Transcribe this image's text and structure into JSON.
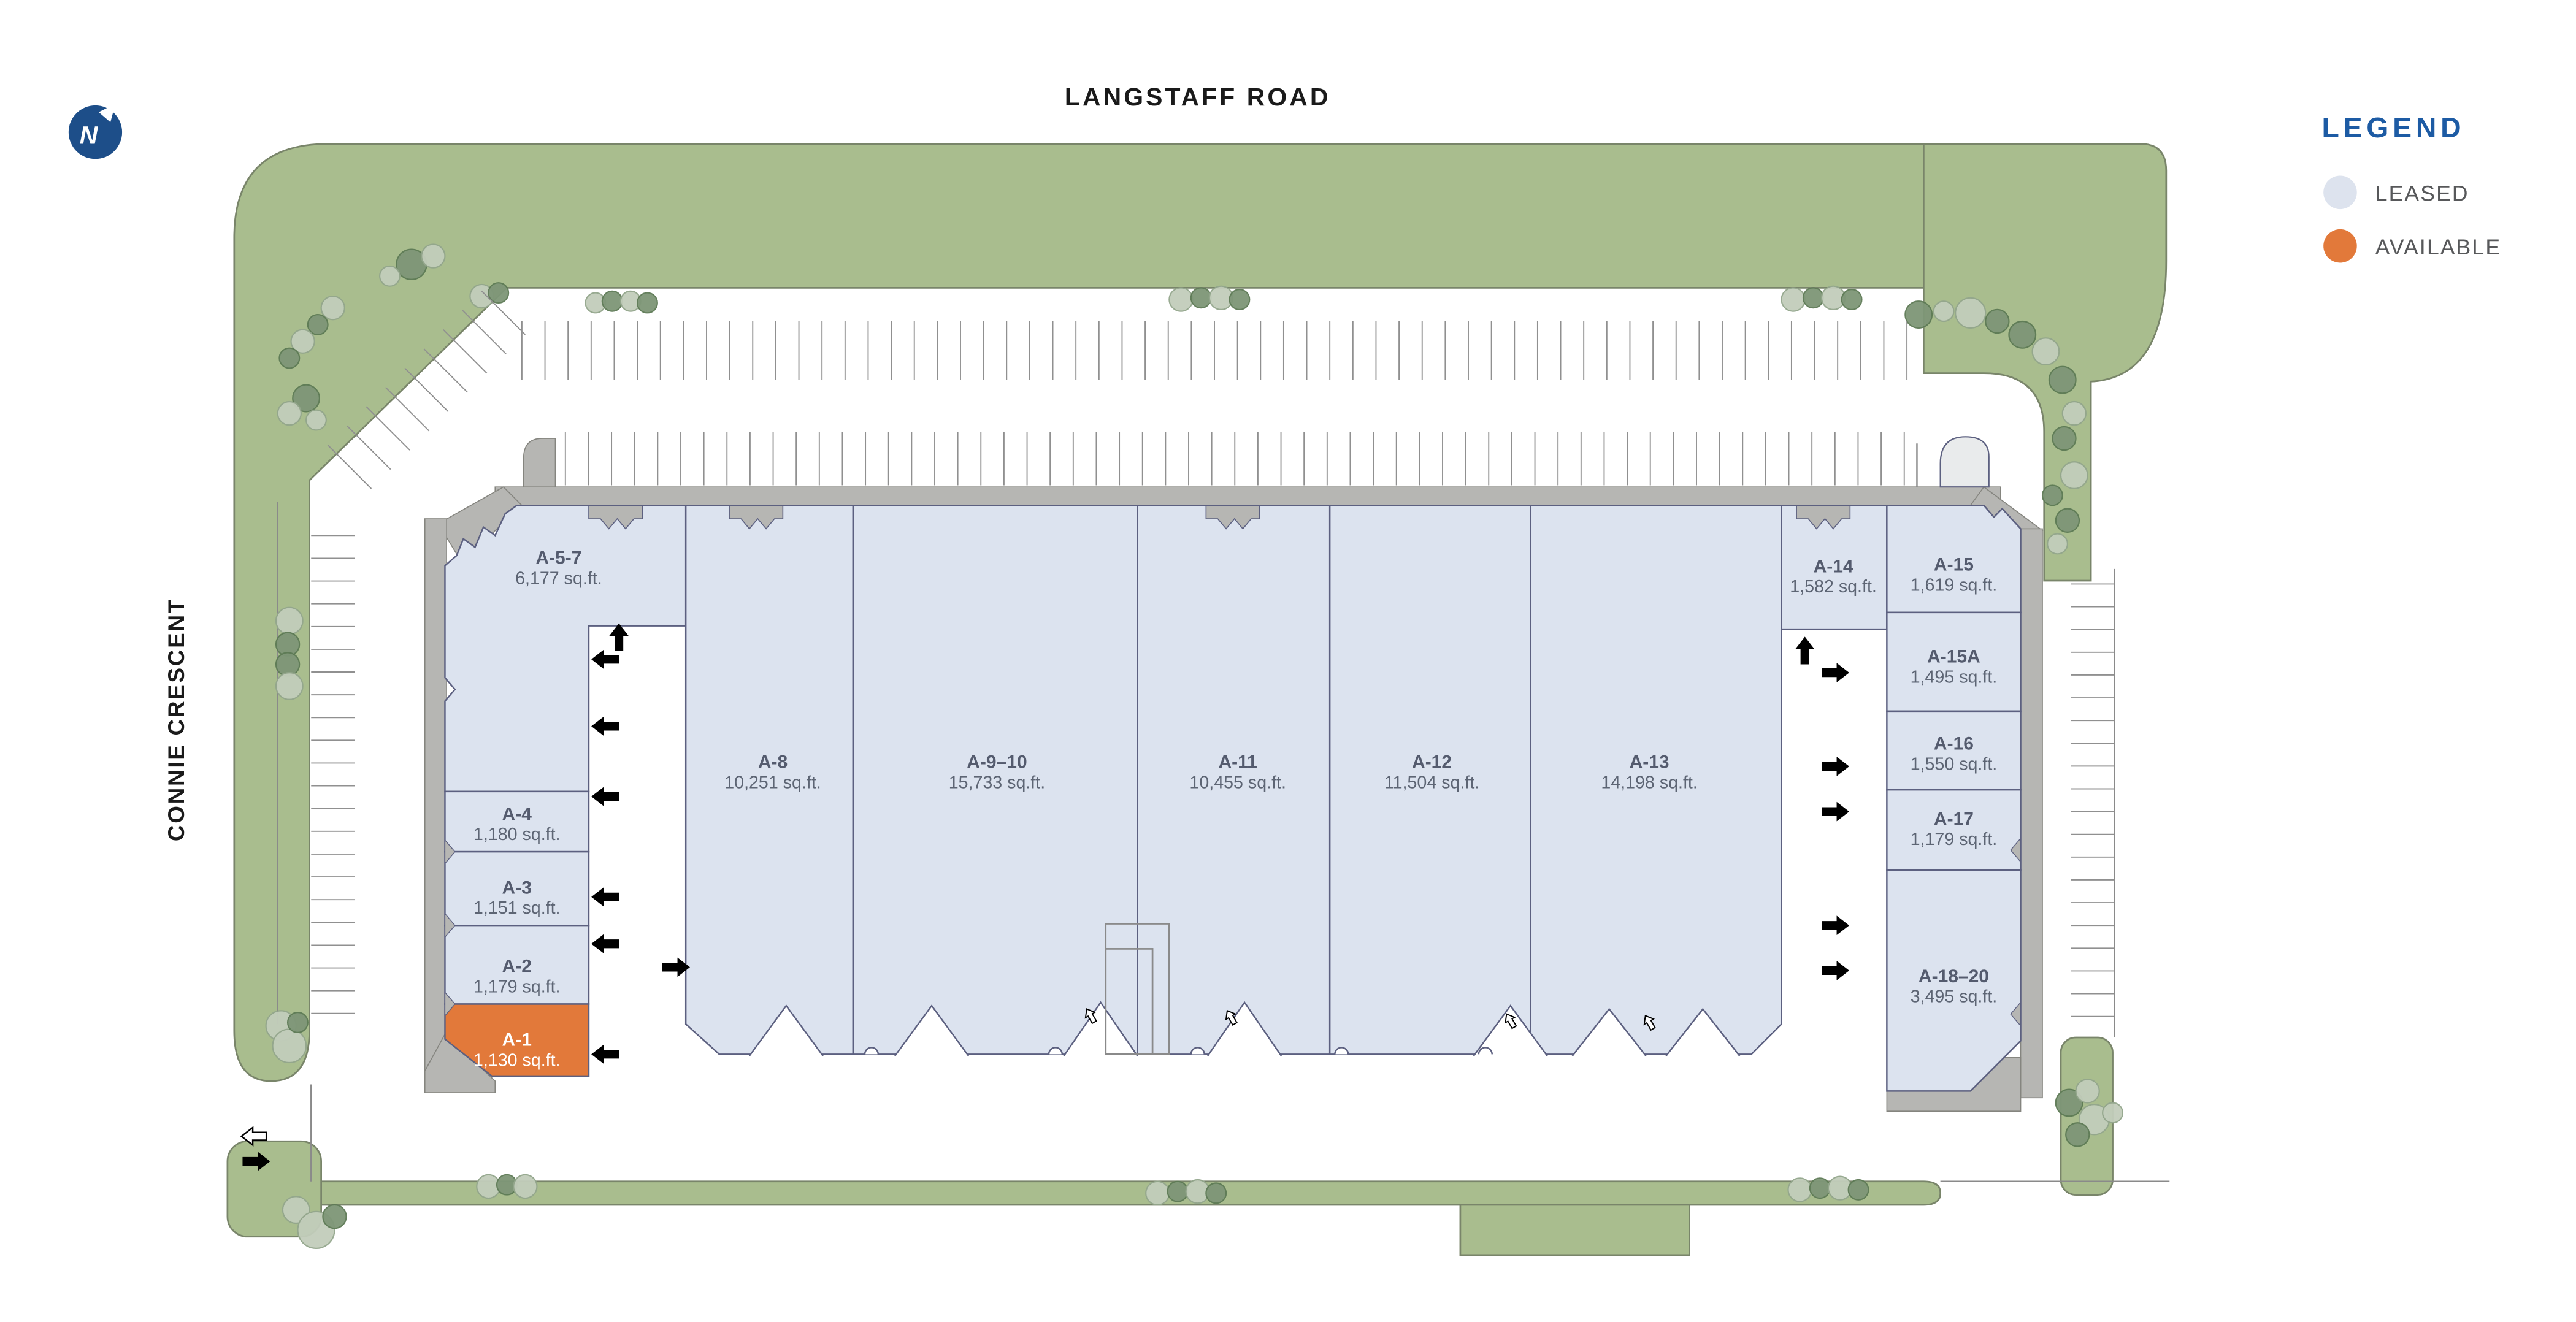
{
  "page": {
    "title": "LANGSTAFF ROAD",
    "left_street": "CONNIE CRESCENT"
  },
  "north": {
    "label": "N"
  },
  "legend": {
    "title": "LEGEND",
    "items": [
      {
        "label": "LEASED",
        "color": "#dde3ee",
        "status": "leased"
      },
      {
        "label": "AVAILABLE",
        "color": "#e2793a",
        "status": "available"
      }
    ]
  },
  "colors": {
    "leased": "#dce3ef",
    "available": "#e2793a",
    "legend_title": "#1d5ba4",
    "wall_gray": "#b6b6b3",
    "landscape_green": "#a9bd8e",
    "label_text": "#545b6e"
  },
  "units": {
    "a5_7": {
      "label": "A-5-7",
      "sqft": "6,177 sq.ft.",
      "status": "leased"
    },
    "a4": {
      "label": "A-4",
      "sqft": "1,180 sq.ft.",
      "status": "leased"
    },
    "a3": {
      "label": "A-3",
      "sqft": "1,151 sq.ft.",
      "status": "leased"
    },
    "a2": {
      "label": "A-2",
      "sqft": "1,179 sq.ft.",
      "status": "leased"
    },
    "a1": {
      "label": "A-1",
      "sqft": "1,130 sq.ft.",
      "status": "available"
    },
    "a8": {
      "label": "A-8",
      "sqft": "10,251 sq.ft.",
      "status": "leased"
    },
    "a9_10": {
      "label": "A-9–10",
      "sqft": "15,733 sq.ft.",
      "status": "leased"
    },
    "a11": {
      "label": "A-11",
      "sqft": "10,455 sq.ft.",
      "status": "leased"
    },
    "a12": {
      "label": "A-12",
      "sqft": "11,504 sq.ft.",
      "status": "leased"
    },
    "a13": {
      "label": "A-13",
      "sqft": "14,198 sq.ft.",
      "status": "leased"
    },
    "a14": {
      "label": "A-14",
      "sqft": "1,582 sq.ft.",
      "status": "leased"
    },
    "a15": {
      "label": "A-15",
      "sqft": "1,619 sq.ft.",
      "status": "leased"
    },
    "a15a": {
      "label": "A-15A",
      "sqft": "1,495 sq.ft.",
      "status": "leased"
    },
    "a16": {
      "label": "A-16",
      "sqft": "1,550 sq.ft.",
      "status": "leased"
    },
    "a17": {
      "label": "A-17",
      "sqft": "1,179 sq.ft.",
      "status": "leased"
    },
    "a18_20": {
      "label": "A-18–20",
      "sqft": "3,495 sq.ft.",
      "status": "leased"
    }
  }
}
